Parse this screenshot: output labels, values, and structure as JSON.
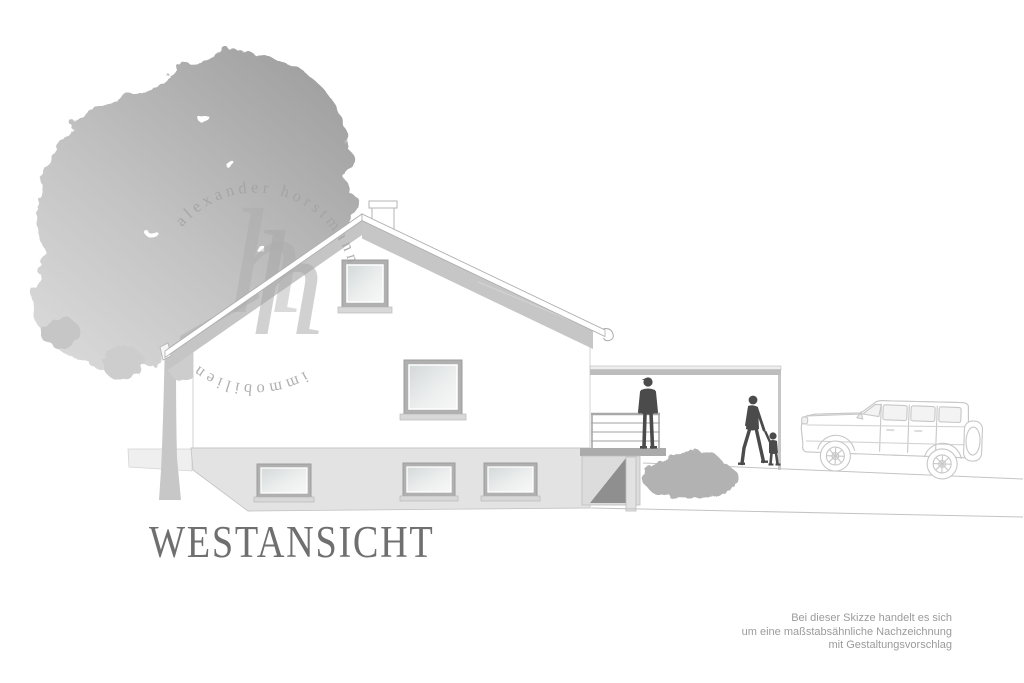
{
  "title": "WESTANSICHT",
  "watermark": {
    "arc_top": "alexander horstmann",
    "arc_bottom": "immobilien",
    "monogram": "h"
  },
  "disclaimer": {
    "line1": "Bei dieser Skizze handelt es sich",
    "line2": "um eine maßstabsähnliche Nachzeichnung",
    "line3": "mit Gestaltungsvorschlag"
  },
  "colors": {
    "background": "#ffffff",
    "roof_band": "#c5c5c5",
    "line": "#c0c0c0",
    "basement": "#e3e3e3",
    "slab": "#ababab",
    "ramp_shadow": "#8f8f8f",
    "silhouette": "#4b4b4b",
    "bush": "#b2b2b2",
    "tree_light": "#d9d9d9",
    "tree_dark": "#a1a1a1",
    "title_text": "#6f6f6f",
    "disclaimer_text": "#9b9b9b",
    "watermark": "#a2a2a2"
  }
}
